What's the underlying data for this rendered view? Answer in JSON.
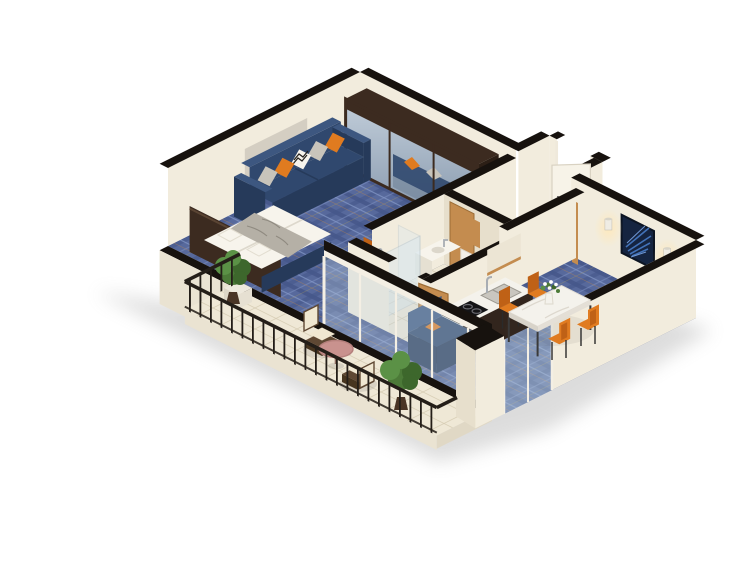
{
  "scene": {
    "type": "isometric-3d-floor-plan",
    "description": "3D dollhouse-style floor plan of a one-bedroom apartment with bedroom-living area, bathroom, kitchenette, dining corner and a long balcony",
    "background": "#ffffff"
  },
  "palette": {
    "background": "#ffffff",
    "wall_cream": "#f2ecdd",
    "wall_shade": "#e7dfcc",
    "wall_cut": "#17120e",
    "slab": "#eae3d2",
    "carpet_base": "#57699c",
    "carpet_dark": "#45568a",
    "carpet_light": "#8296c6",
    "carpet_accent_warm": "#c9883f",
    "carpet_accent_gold": "#c2a948",
    "tile": "#efe8d6",
    "tile_line": "#d8cdb4",
    "sofa_navy": "#30486e",
    "sofa_navy_light": "#3d5780",
    "sofa_navy_dark": "#263a5a",
    "accent_orange": "#e07b20",
    "accent_orange_dark": "#bf6116",
    "pillow_gray": "#c8c4bb",
    "bedding_white": "#f7f4ec",
    "blanket_gray": "#b5b0a6",
    "wood_dark": "#3c2b20",
    "wood_darker": "#2c1f16",
    "oak": "#c48c4f",
    "oak_dark": "#9c6c35",
    "cabinet_espresso": "#32251d",
    "cabinet_espresso_dark": "#241a14",
    "marble": "#f4f2ec",
    "glass_blue": "#c2d4e2",
    "steel": "#a8adb3",
    "railing_metal": "#241e18",
    "wicker_brown": "#5f4833",
    "wicker_brown_dark": "#47351f",
    "cushion_cream": "#f0e7d1",
    "table_pink": "#c9928e",
    "plant_pot": "#4a3526",
    "plant_green": "#4c7a38",
    "plant_green_light": "#5b9146",
    "plant_green_dark": "#3d672c",
    "art_navy": "#152440",
    "art_leaf_blue": "#4272b8",
    "art_leaf_light": "#6f97d4",
    "sconce_glow": "#ffdf9e",
    "cooktop_black": "#141416",
    "door_white": "#f7f3e8"
  },
  "rooms": [
    {
      "name": "bedroom-living",
      "floor": "blue plaid carpet",
      "furniture": [
        "mirrored-wardrobe",
        "navy-sofa",
        "orange-gray-chevron-pillows",
        "double-bed-white-duvet",
        "dark-headboard",
        "desk",
        "orange-desk-chair"
      ]
    },
    {
      "name": "entry-hall",
      "floor": "blue plaid carpet",
      "furniture": [
        "white-entry-door",
        "oak-coat-panel"
      ]
    },
    {
      "name": "bathroom",
      "floor": "beige tile",
      "furniture": [
        "wall-hung-toilet",
        "glass-shower",
        "sink-counter",
        "oak-door-open",
        "oak-wall-cabinet"
      ]
    },
    {
      "name": "kitchenette",
      "floor": "blue plaid carpet",
      "furniture": [
        "espresso-island-marble-top",
        "double-sink",
        "four-burner-cooktop",
        "upper-cabinet"
      ]
    },
    {
      "name": "dining-corner",
      "floor": "blue plaid carpet",
      "furniture": [
        "marble-dining-table",
        "four-orange-chairs",
        "flower-vase",
        "blue-leaf-wall-art",
        "two-wall-sconces",
        "navy-armchair-orange-pillow"
      ]
    },
    {
      "name": "balcony",
      "floor": "beige tile",
      "furniture": [
        "black-metal-railing",
        "two-wicker-armchairs",
        "round-pink-coffee-table",
        "two-potted-shrubs",
        "white-planter-box",
        "glass-window-wall"
      ]
    }
  ]
}
